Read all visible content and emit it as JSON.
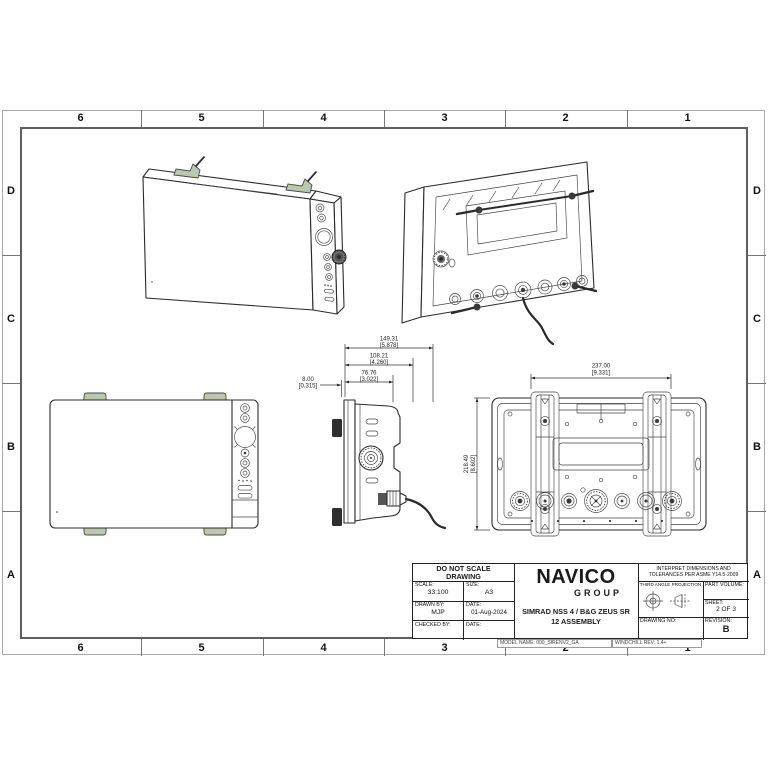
{
  "sheet": {
    "zones": {
      "columns": [
        "6",
        "5",
        "4",
        "3",
        "2",
        "1"
      ],
      "rows": [
        "D",
        "C",
        "B",
        "A"
      ]
    },
    "footer": {
      "model_name": "MODEL NAME: 000_SIRENV2_GA",
      "windchill": "WINDCHILL REV: 1.4+"
    }
  },
  "title_block": {
    "do_not_scale_line1": "DO NOT SCALE",
    "do_not_scale_line2": "DRAWING",
    "scale_label": "SCALE:",
    "scale_value": "33:100",
    "size_label": "SIZE:",
    "size_value": "A3",
    "drawn_by_label": "DRAWN BY:",
    "drawn_by_value": "MJP",
    "date_label": "DATE:",
    "date_value": "01-Aug-2024",
    "checked_by_label": "CHECKED BY:",
    "checked_by_value": "",
    "checked_date_label": "DATE:",
    "checked_date_value": "",
    "logo_line1": "NAVICO",
    "logo_line2": "GROUP",
    "product_line1": "SIMRAD NSS 4 / B&G ZEUS SR",
    "product_line2": "12 ASSEMBLY",
    "interpret_line1": "INTERPRET DIMENSIONS AND",
    "interpret_line2": "TOLERANCES PER ASME Y14.5-2009",
    "projection_label": "THIRD ANGLE PROJECTION",
    "part_volume_label": "PART VOLUME:",
    "sheet_label": "SHEET:",
    "sheet_value": "2 OF 3",
    "drawing_no_label": "DRAWING NO:",
    "revision_label": "REVISION:",
    "revision_value": "B"
  },
  "dimensions": {
    "depth_total": {
      "mm": "149.31",
      "in": "[5.878]"
    },
    "depth_mid": {
      "mm": "108.21",
      "in": "[4.260]"
    },
    "depth_front": {
      "mm": "76.76",
      "in": "[3.022]"
    },
    "bezel": {
      "mm": "8.00",
      "in": "[0.315]"
    },
    "width_mount": {
      "mm": "237.00",
      "in": "[9.331]"
    },
    "height": {
      "mm": "218.49",
      "in": "[8.602]"
    }
  }
}
